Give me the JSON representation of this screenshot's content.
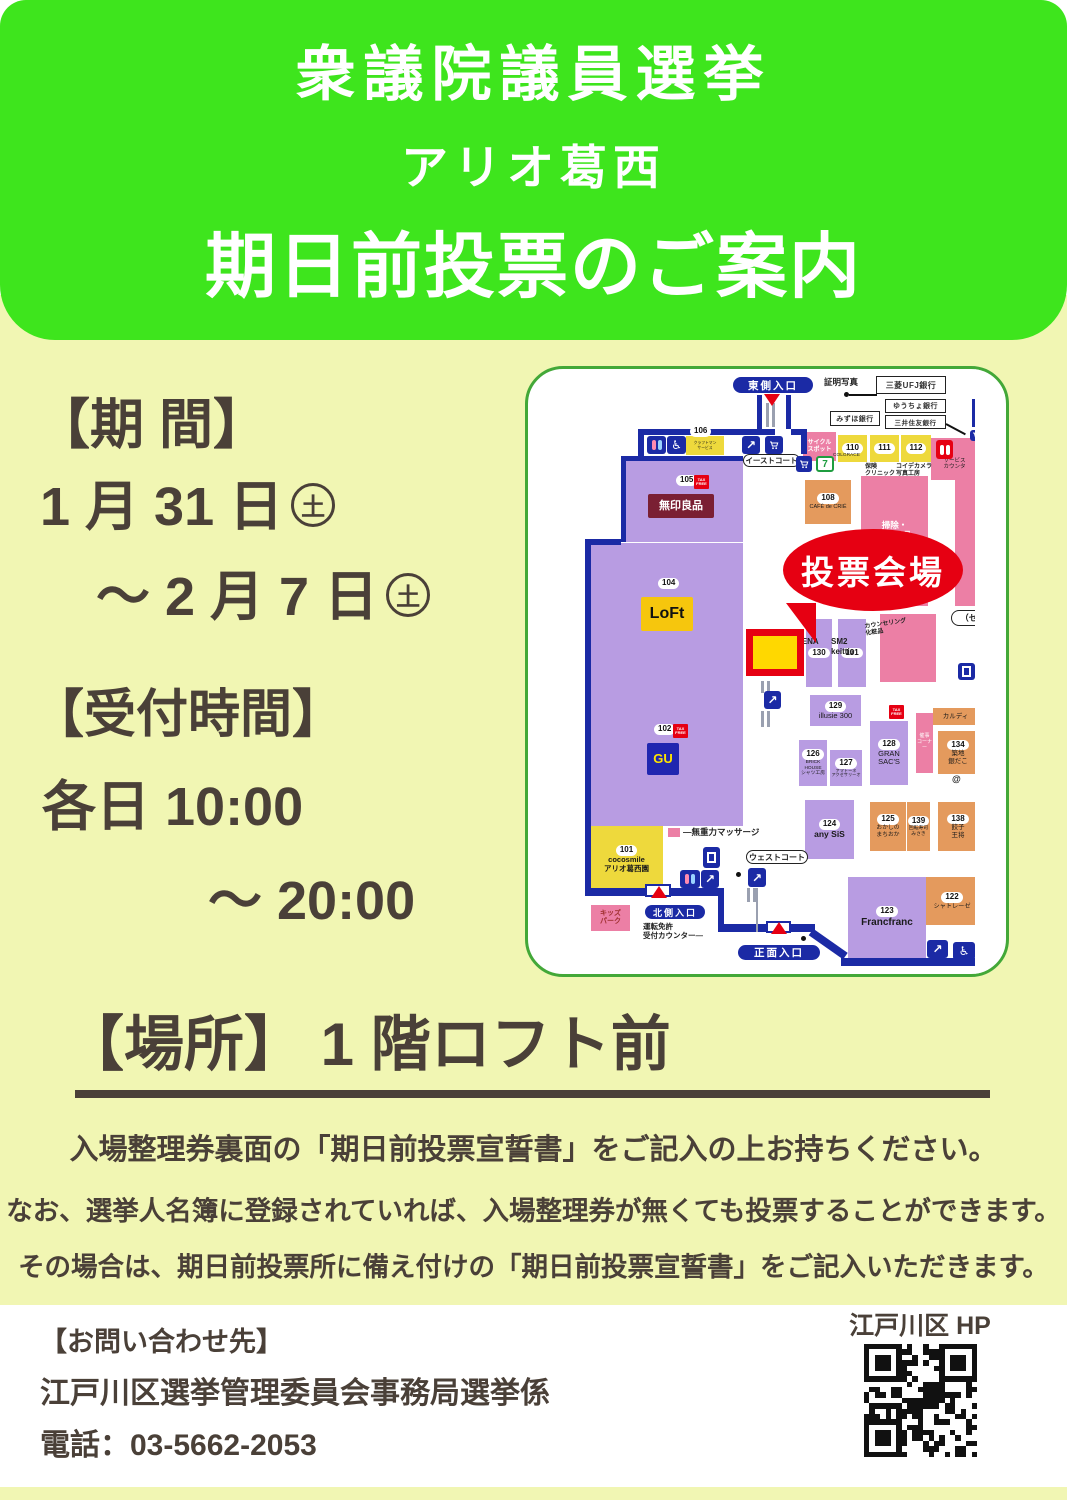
{
  "header": {
    "line1": "衆議院議員選挙",
    "line2": "アリオ葛西",
    "line3": "期日前投票のご案内"
  },
  "info": {
    "period_label": "【期 間】",
    "period_from": "1 月 31 日",
    "period_from_mark": "土",
    "period_to": "～ 2 月 7 日",
    "period_to_mark": "土",
    "hours_label": "【受付時間】",
    "hours_line1": "各日 10:00",
    "hours_line2": "～ 20:00",
    "place_line": "【場所】 1 階ロフト前"
  },
  "notes": {
    "line1": "入場整理券裏面の「期日前投票宣誓書」をご記入の上お持ちください。",
    "line2": "なお、選挙人名簿に登録されていれば、入場整理券が無くても投票することができます。",
    "line3": "その場合は、期日前投票所に備え付けの「期日前投票宣誓書」をご記入いただきます。"
  },
  "footer": {
    "contact_label": "【お問い合わせ先】",
    "org": "江戸川区選挙管理委員会事務局選挙係",
    "tel": "電話：03-5662-2053",
    "hp_label": "江戸川区 HP",
    "qr_icon": "qr-code"
  },
  "map": {
    "palette": {
      "purple": "#b89ce2",
      "yellow": "#eed93c",
      "orange": "#e49a5d",
      "pink": "#ec7fa5",
      "blue": "#1b2aa5",
      "red": "#e60012",
      "gray": "#9aa0b0",
      "ink": "#1a1a1a"
    },
    "voting": {
      "label": "投票会場",
      "label_fs": 33,
      "ellipse": {
        "x": 255,
        "y": 160,
        "w": 180,
        "h": 82
      },
      "pointer": {
        "x": 258,
        "y": 234
      },
      "spot": {
        "x": 218,
        "y": 260,
        "w": 58,
        "h": 47
      }
    },
    "blocks": [
      {
        "x": 93,
        "y": 87,
        "w": 122,
        "h": 86,
        "c": "purple",
        "wall": 1
      },
      {
        "x": 58,
        "y": 174,
        "w": 157,
        "h": 139,
        "c": "purple"
      },
      {
        "x": 60,
        "y": 311,
        "w": 155,
        "h": 146,
        "c": "purple"
      },
      {
        "x": 158,
        "y": 67,
        "w": 38,
        "h": 19,
        "c": "yellow",
        "label": "クラフトマン\nサービス",
        "fs": 3.8
      },
      {
        "x": 277,
        "y": 111,
        "w": 46,
        "h": 44,
        "c": "orange",
        "num": "108",
        "label": "CAFÉ de CRIÉ",
        "fs": 5.5
      },
      {
        "x": 333,
        "y": 107,
        "w": 67,
        "h": 130,
        "c": "pink",
        "label": "掃除・\n洗濯用品\n\nキッチン",
        "fs": 8.5,
        "lc": "#ffffff",
        "bold": 1
      },
      {
        "x": 427,
        "y": 107,
        "w": 38,
        "h": 130,
        "c": "pink"
      },
      {
        "x": 278,
        "y": 250,
        "w": 26,
        "h": 68,
        "c": "purple",
        "num": "130"
      },
      {
        "x": 310,
        "y": 250,
        "w": 28,
        "h": 68,
        "c": "purple",
        "num": "131"
      },
      {
        "x": 352,
        "y": 245,
        "w": 56,
        "h": 68,
        "c": "pink"
      },
      {
        "x": 282,
        "y": 326,
        "w": 51,
        "h": 31,
        "c": "purple",
        "num": "129",
        "label": "illusie 300",
        "fs": 7.5
      },
      {
        "x": 271,
        "y": 371,
        "w": 28,
        "h": 46,
        "c": "purple",
        "num": "126",
        "label": "BRICK\nHOUSE\nシャツ工房",
        "fs": 4.8
      },
      {
        "x": 302,
        "y": 381,
        "w": 32,
        "h": 36,
        "c": "purple",
        "num": "127",
        "label": "アマトーネ\nアクセサリーオ",
        "fs": 4.2
      },
      {
        "x": 342,
        "y": 352,
        "w": 38,
        "h": 64,
        "c": "purple",
        "num": "128",
        "label": "GRAN\nSAC'S",
        "fs": 7.5
      },
      {
        "x": 388,
        "y": 344,
        "w": 17,
        "h": 60,
        "c": "pink",
        "label": "催事\nコーナー",
        "fs": 5,
        "lc": "#ffffff"
      },
      {
        "x": 405,
        "y": 339,
        "w": 45,
        "h": 17,
        "c": "orange",
        "label": "カルディ",
        "fs": 6.5
      },
      {
        "x": 410,
        "y": 362,
        "w": 40,
        "h": 43,
        "c": "orange",
        "num": "134",
        "label": "築地\n銀だこ",
        "fs": 6.5
      },
      {
        "x": 277,
        "y": 431,
        "w": 49,
        "h": 59,
        "c": "purple",
        "num": "124",
        "label": "any SiS",
        "fs": 8.5,
        "bold": 1
      },
      {
        "x": 342,
        "y": 433,
        "w": 36,
        "h": 49,
        "c": "orange",
        "num": "125",
        "label": "おかしの\nまちおか",
        "fs": 5.8
      },
      {
        "x": 379,
        "y": 433,
        "w": 23,
        "h": 49,
        "c": "orange",
        "num": "139",
        "label": "回転寿司\nみさき",
        "fs": 4.8
      },
      {
        "x": 410,
        "y": 433,
        "w": 40,
        "h": 49,
        "c": "orange",
        "num": "138",
        "label": "餃子\n王将",
        "fs": 6.5
      },
      {
        "x": 62,
        "y": 457,
        "w": 73,
        "h": 67,
        "c": "yellow",
        "num": "101",
        "label": "cocosmile\nアリオ葛西園",
        "fs": 7.5,
        "bold": 1
      },
      {
        "x": 140,
        "y": 459,
        "w": 12,
        "h": 9,
        "c": "pink"
      },
      {
        "x": 63,
        "y": 536,
        "w": 39,
        "h": 26,
        "c": "pink",
        "label": "キッズ\nパーク",
        "fs": 7,
        "lc": "#a03030",
        "bold": 1
      },
      {
        "x": 320,
        "y": 508,
        "w": 78,
        "h": 81,
        "c": "purple",
        "num": "123",
        "label": "Francfranc",
        "fs": 10,
        "bold": 1
      },
      {
        "x": 398,
        "y": 508,
        "w": 52,
        "h": 48,
        "c": "orange",
        "num": "122",
        "label": "シャトレーゼ",
        "fs": 6.2
      },
      {
        "x": 275,
        "y": 63,
        "w": 33,
        "h": 29,
        "c": "pink",
        "label": "サイクル\nスポット",
        "fs": 6,
        "lc": "#ffffff",
        "bold": 1
      },
      {
        "x": 310,
        "y": 66,
        "w": 29,
        "h": 27,
        "c": "yellow",
        "num": "110"
      },
      {
        "x": 342,
        "y": 66,
        "w": 29,
        "h": 27,
        "c": "yellow",
        "num": "111"
      },
      {
        "x": 373,
        "y": 66,
        "w": 30,
        "h": 27,
        "c": "yellow",
        "num": "112"
      },
      {
        "x": 403,
        "y": 69,
        "w": 47,
        "h": 42,
        "c": "pink",
        "label": "サービス\nカウンタ",
        "fs": 5.5,
        "padTop": 20
      }
    ],
    "logos": [
      {
        "x": 120,
        "y": 125,
        "w": 66,
        "h": 24,
        "bg": "#7a1f33",
        "fg": "#ffffff",
        "t": "無印良品",
        "fs": 11,
        "name": "muji-logo"
      },
      {
        "x": 113,
        "y": 228,
        "w": 52,
        "h": 34,
        "bg": "#f6c60d",
        "fg": "#111111",
        "t": "LoFt",
        "fs": 16,
        "name": "loft-logo"
      },
      {
        "x": 119,
        "y": 374,
        "w": 32,
        "h": 32,
        "bg": "#2026b0",
        "fg": "#ffe400",
        "t": "GU",
        "fs": 13,
        "name": "gu-logo"
      }
    ],
    "numchips": [
      {
        "x": 148,
        "y": 106,
        "t": "105"
      },
      {
        "x": 130,
        "y": 209,
        "t": "104"
      },
      {
        "x": 126,
        "y": 355,
        "t": "102"
      },
      {
        "x": 162,
        "y": 57,
        "t": "106"
      }
    ],
    "taxchips": [
      {
        "x": 166,
        "y": 106
      },
      {
        "x": 145,
        "y": 355
      },
      {
        "x": 361,
        "y": 336
      }
    ],
    "tax_label": "TAX\nFREE",
    "pills": [
      {
        "x": 205,
        "y": 8,
        "w": 80,
        "h": 16,
        "t": "東側入口",
        "fs": 10.5
      },
      {
        "x": 117,
        "y": 536,
        "w": 60,
        "h": 14,
        "t": "北側入口",
        "fs": 9
      },
      {
        "x": 210,
        "y": 576,
        "w": 82,
        "h": 15,
        "t": "正面入口",
        "fs": 10.5
      }
    ],
    "ovals": [
      {
        "x": 215,
        "y": 85,
        "w": 57,
        "h": 13,
        "t": "イーストコート",
        "fs": 7.5
      },
      {
        "x": 218,
        "y": 481,
        "w": 62,
        "h": 14,
        "t": "ウェストコート",
        "fs": 8
      },
      {
        "x": 423,
        "y": 241,
        "w": 44,
        "h": 16,
        "t": "（セン",
        "fs": 8.5
      }
    ],
    "banks": [
      {
        "x": 348,
        "y": 7,
        "w": 70,
        "h": 18,
        "t": "三菱UFJ銀行",
        "fs": 8
      },
      {
        "x": 357,
        "y": 30,
        "w": 61,
        "h": 14,
        "t": "ゆうちょ銀行",
        "fs": 7
      },
      {
        "x": 302,
        "y": 42,
        "w": 50,
        "h": 15,
        "t": "みずほ銀行",
        "fs": 7
      },
      {
        "x": 357,
        "y": 46,
        "w": 61,
        "h": 14,
        "t": "三井住友銀行",
        "fs": 6.5
      }
    ],
    "texts": [
      {
        "x": 296,
        "y": 8,
        "t": "証明写真",
        "fs": 8.5,
        "bold": 1
      },
      {
        "x": 305,
        "y": 84,
        "t": "COLGRACE",
        "fs": 4.8
      },
      {
        "x": 337,
        "y": 95,
        "t": "保険\nクリニック",
        "fs": 6,
        "bold": 1
      },
      {
        "x": 368,
        "y": 95,
        "t": "コイデカメラ\n写真工房",
        "fs": 6,
        "bold": 1
      },
      {
        "x": 268,
        "y": 268,
        "t": "AENA",
        "fs": 8,
        "bold": 1
      },
      {
        "x": 303,
        "y": 268,
        "t": "SM2\nkeittio",
        "fs": 8,
        "bold": 1
      },
      {
        "x": 337,
        "y": 252,
        "t": "カウンセリング\n化粧品",
        "fs": 6,
        "bold": 1,
        "rot": -8
      },
      {
        "x": 155,
        "y": 458,
        "t": "―無重力マッサージ",
        "fs": 8.5,
        "bold": 1
      },
      {
        "x": 115,
        "y": 553,
        "t": "運転免許\n受付カウンター―",
        "fs": 7.5,
        "bold": 1
      },
      {
        "x": 424,
        "y": 405,
        "t": "@",
        "fs": 9,
        "bold": 1
      }
    ],
    "paths": [
      {
        "x": 110,
        "y": 60,
        "w": 137,
        "h": 6
      },
      {
        "x": 110,
        "y": 60,
        "w": 6,
        "h": 27
      },
      {
        "x": 263,
        "y": 60,
        "w": 15,
        "h": 6
      },
      {
        "x": 273,
        "y": 60,
        "w": 6,
        "h": 25
      },
      {
        "x": 229,
        "y": 26,
        "w": 5,
        "h": 34
      },
      {
        "x": 258,
        "y": 26,
        "w": 5,
        "h": 34
      },
      {
        "x": 57,
        "y": 172,
        "w": 6,
        "h": 355
      },
      {
        "x": 57,
        "y": 170,
        "w": 36,
        "h": 6
      },
      {
        "x": 57,
        "y": 519,
        "w": 62,
        "h": 8
      },
      {
        "x": 143,
        "y": 519,
        "w": 52,
        "h": 8
      },
      {
        "x": 190,
        "y": 519,
        "w": 6,
        "h": 44
      },
      {
        "x": 190,
        "y": 555,
        "w": 48,
        "h": 8
      },
      {
        "x": 263,
        "y": 555,
        "w": 24,
        "h": 8
      },
      {
        "x": 283,
        "y": 559,
        "w": 42,
        "h": 8,
        "rot": 35
      },
      {
        "x": 313,
        "y": 589,
        "w": 137,
        "h": 8
      },
      {
        "x": 444,
        "y": 30,
        "w": 19,
        "h": 28
      }
    ],
    "grays": [
      {
        "x": 238,
        "y": 34,
        "w": 3,
        "h": 24
      },
      {
        "x": 244,
        "y": 34,
        "w": 3,
        "h": 24
      },
      {
        "x": 233,
        "y": 312,
        "w": 3,
        "h": 12
      },
      {
        "x": 239,
        "y": 312,
        "w": 3,
        "h": 12
      },
      {
        "x": 233,
        "y": 342,
        "w": 3,
        "h": 16
      },
      {
        "x": 239,
        "y": 342,
        "w": 3,
        "h": 16
      },
      {
        "x": 219,
        "y": 519,
        "w": 3,
        "h": 14
      },
      {
        "x": 225,
        "y": 519,
        "w": 3,
        "h": 14
      },
      {
        "x": 228,
        "y": 519,
        "w": 2,
        "h": 44
      }
    ],
    "dots": [
      {
        "x": 316,
        "y": 23
      },
      {
        "x": 208,
        "y": 503
      },
      {
        "x": 273,
        "y": 567
      }
    ],
    "clines": [
      {
        "x": 321,
        "y": 25,
        "w": 28,
        "h": 2
      },
      {
        "x": 418,
        "y": 54,
        "w": 22,
        "h": 2,
        "rot": 28
      }
    ],
    "tris": [
      {
        "x": 236,
        "y": 25,
        "dir": "down"
      },
      {
        "x": 123,
        "y": 517,
        "dir": "up"
      },
      {
        "x": 243,
        "y": 553,
        "dir": "up"
      }
    ],
    "gapboxes": [
      {
        "x": 117,
        "y": 515,
        "w": 26,
        "h": 13
      },
      {
        "x": 238,
        "y": 552,
        "w": 25,
        "h": 12
      }
    ],
    "icons": [
      {
        "x": 119,
        "y": 67,
        "w": 19,
        "h": 18,
        "t": "wc"
      },
      {
        "x": 139,
        "y": 67,
        "w": 19,
        "h": 18,
        "t": "wheel"
      },
      {
        "x": 214,
        "y": 67,
        "w": 18,
        "h": 18,
        "t": "esc"
      },
      {
        "x": 237,
        "y": 67,
        "w": 18,
        "h": 18,
        "t": "cart"
      },
      {
        "x": 268,
        "y": 87,
        "w": 16,
        "h": 16,
        "t": "cart"
      },
      {
        "x": 288,
        "y": 87,
        "w": 18,
        "h": 16,
        "t": "seven"
      },
      {
        "x": 408,
        "y": 71,
        "w": 17,
        "h": 19,
        "t": "wcred"
      },
      {
        "x": 236,
        "y": 322,
        "w": 17,
        "h": 18,
        "t": "esc"
      },
      {
        "x": 175,
        "y": 478,
        "w": 17,
        "h": 21,
        "t": "elev"
      },
      {
        "x": 152,
        "y": 501,
        "w": 20,
        "h": 18,
        "t": "wc"
      },
      {
        "x": 173,
        "y": 501,
        "w": 18,
        "h": 18,
        "t": "esc"
      },
      {
        "x": 220,
        "y": 499,
        "w": 18,
        "h": 19,
        "t": "esc"
      },
      {
        "x": 399,
        "y": 571,
        "w": 21,
        "h": 18,
        "t": "esc"
      },
      {
        "x": 425,
        "y": 573,
        "w": 22,
        "h": 18,
        "t": "wheel"
      },
      {
        "x": 430,
        "y": 294,
        "w": 17,
        "h": 17,
        "t": "elev"
      },
      {
        "x": 442,
        "y": 61,
        "w": 13,
        "h": 11,
        "t": "cart"
      }
    ]
  }
}
